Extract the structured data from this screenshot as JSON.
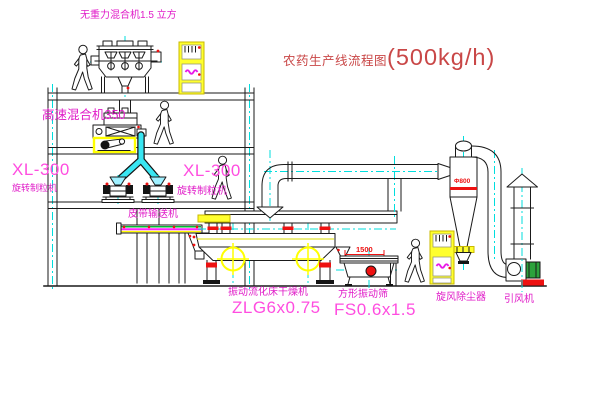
{
  "title": {
    "text": "农药生产线流程图",
    "capacity": "(500kg/h)"
  },
  "equipment_labels": {
    "gravity_mixer": "无重力混合机1.5 立方",
    "high_speed_mixer": "高速混合机350",
    "granulator_left": {
      "model": "XL-300",
      "name": "旋转制粒机"
    },
    "granulator_right": {
      "model": "XL-300",
      "name": "旋转制粒机"
    },
    "belt_conveyor": "皮带输送机",
    "dryer": {
      "name": "振动流化床干燥机",
      "model": "ZLG6x0.75"
    },
    "sieve": {
      "name": "方形振动筛",
      "model": "FS0.6x1.5"
    },
    "cyclone": "旋风除尘器",
    "fan": "引风机"
  },
  "dimensions": {
    "sieve_length": "1500",
    "cyclone_note": "Φ800"
  },
  "colors": {
    "label_magenta": "#e01cc8",
    "model_pink": "#ff4de0",
    "title_red": "#c94747",
    "dim_red": "#ee1111",
    "highlight_yellow": "#ffff00",
    "centerline_cyan": "#00dede",
    "motor_green": "#2ca23c",
    "line_black": "#1a1a1a"
  }
}
